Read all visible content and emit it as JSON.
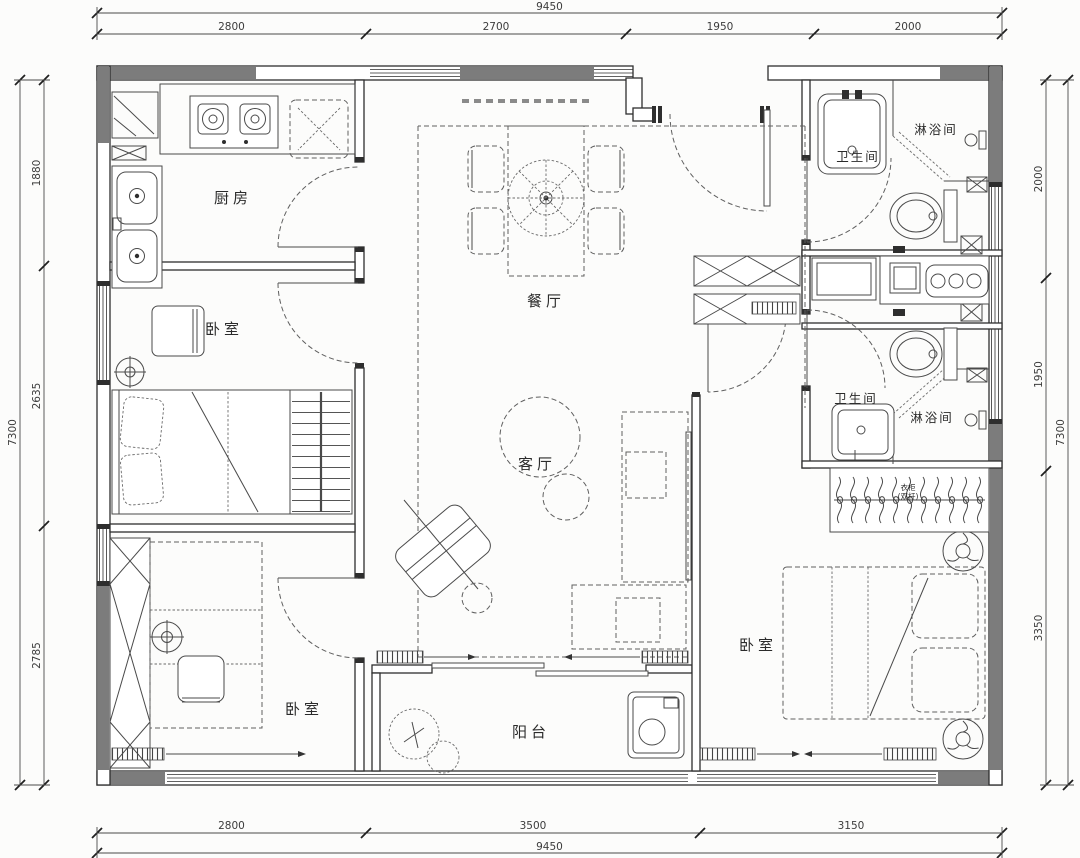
{
  "plan": {
    "rooms": {
      "kitchen": "厨房",
      "bedroom_left_middle": "卧室",
      "bedroom_left_bottom": "卧室",
      "dining": "餐厅",
      "living": "客厅",
      "balcony": "阳台",
      "bedroom_master": "卧室",
      "bathroom_top": "卫生间",
      "shower_top": "淋浴间",
      "bathroom_middle": "卫生间",
      "shower_middle": "淋浴间",
      "closet_line1": "衣柜",
      "closet_line2": "(双杆)"
    },
    "dimensions": {
      "top": {
        "total": "9450",
        "segments": [
          "2800",
          "2700",
          "1950",
          "2000"
        ]
      },
      "bottom": {
        "total": "9450",
        "segments": [
          "2800",
          "3500",
          "3150"
        ]
      },
      "left": {
        "total": "7300",
        "segments": [
          "1880",
          "2635",
          "2785"
        ]
      },
      "right": {
        "total": "7300",
        "segments": [
          "2000",
          "1950",
          "3350"
        ]
      }
    },
    "colors": {
      "wall_fill": "#7c7c7c",
      "line": "#2e2e2e",
      "paper": "#fcfcfb"
    }
  }
}
